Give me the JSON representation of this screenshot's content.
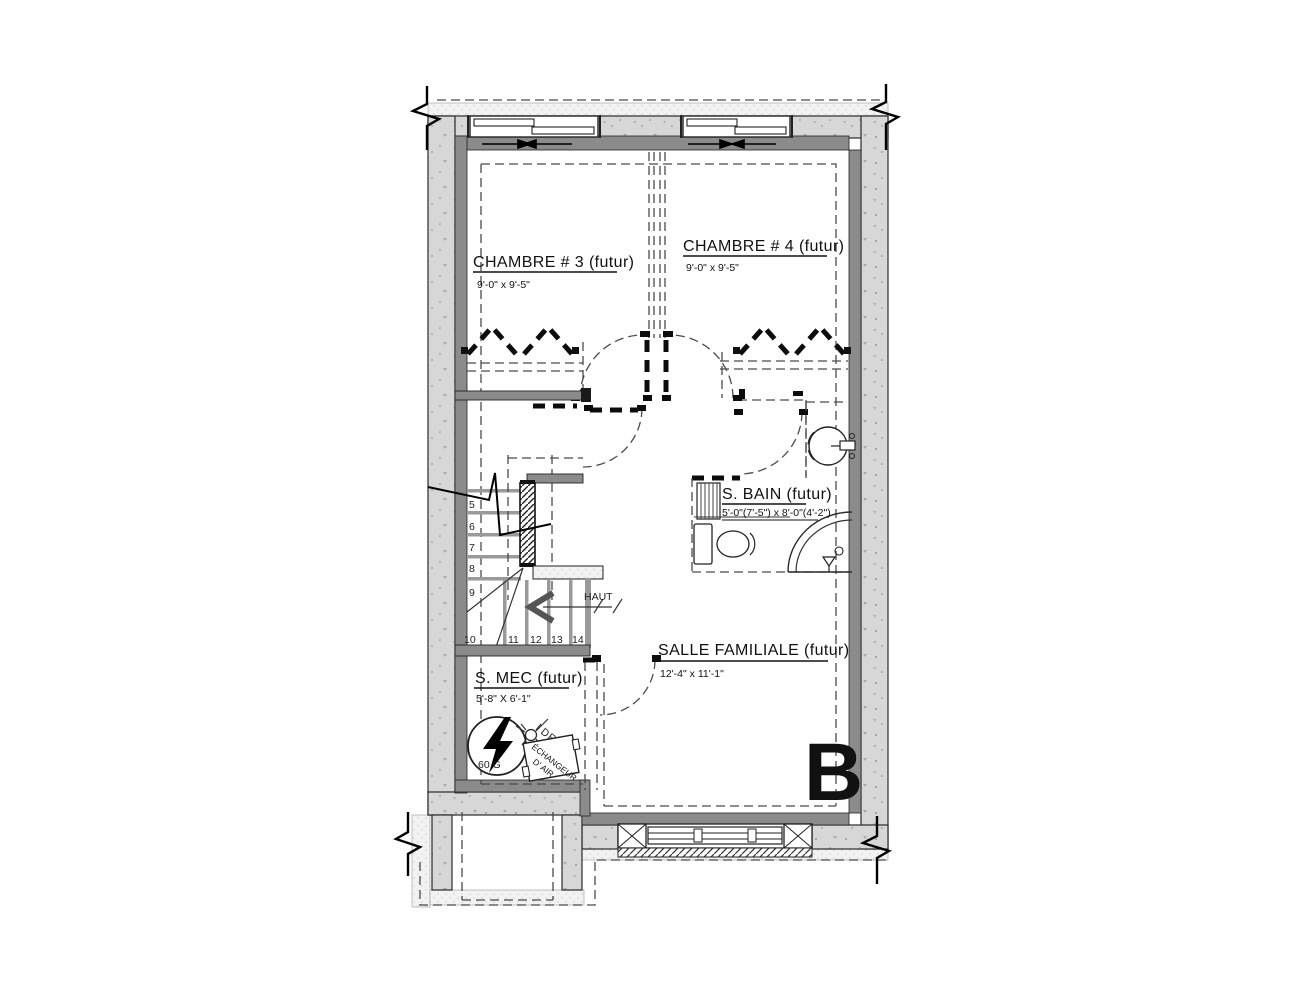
{
  "unit_label": "B",
  "rooms": {
    "chambre3": {
      "name": "CHAMBRE # 3 (futur)",
      "dims": "9'-0\" x 9'-5\""
    },
    "chambre4": {
      "name": "CHAMBRE # 4 (futur)",
      "dims": "9'-0\" x 9'-5\""
    },
    "salle_bain": {
      "name": "S. BAIN (futur)",
      "dims": "5'-0\"(7'-5\") x 8'-0\"(4'-2\")"
    },
    "salle_familiale": {
      "name": "SALLE FAMILIALE (futur)",
      "dims": "12'-4\" x 11'-1\""
    },
    "salle_mec": {
      "name": "S. MEC (futur)",
      "dims": "5'-8\" X 6'-1\""
    }
  },
  "stairs": {
    "up_label": "HAUT",
    "numbers": [
      "5",
      "6",
      "7",
      "8",
      "9",
      "10",
      "11",
      "12",
      "13",
      "14"
    ]
  },
  "equipment": {
    "water_heater_label": "60 G",
    "drain_label": "DRAIN",
    "air_exchanger_line1": "ÉCHANGEUR",
    "air_exchanger_line2": "D' AIR"
  },
  "colors": {
    "concrete": "#d7d7d7",
    "furring": "#8b8b8b",
    "stipple": "#f2f2f2",
    "ink": "#1a1a1a"
  }
}
